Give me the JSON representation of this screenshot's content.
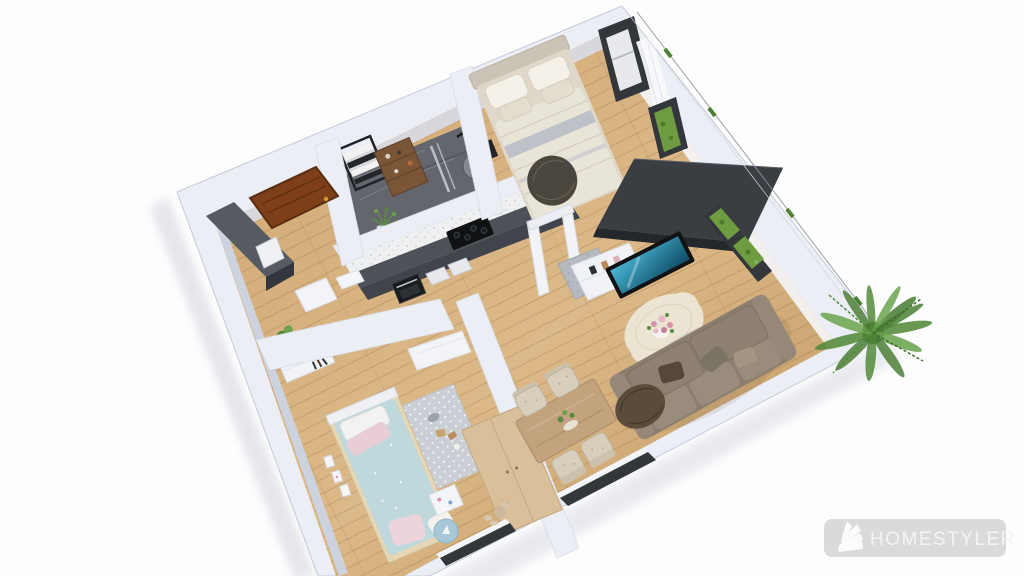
{
  "app": {
    "watermark_label": "HOMESTYLER"
  },
  "scene": {
    "view": "3d-top-down-floorplan-render",
    "rooms": [
      {
        "name": "entrance-hall",
        "items": [
          "entry-door",
          "shoe-wardrobe",
          "storage-shelf"
        ]
      },
      {
        "name": "bathroom",
        "items": [
          "towel-ladder",
          "wood-shelf",
          "shower-column",
          "glass-partition",
          "plant"
        ]
      },
      {
        "name": "bedroom",
        "items": [
          "double-bed",
          "round-dark-throw",
          "wardrobe",
          "corner-windows",
          "curtain"
        ]
      },
      {
        "name": "kitchen",
        "items": [
          "counter",
          "oven",
          "cooktop",
          "marble-backsplash"
        ]
      },
      {
        "name": "living-dining",
        "items": [
          "sofa",
          "cream-rug",
          "flower-centerpiece",
          "tv",
          "media-console",
          "dining-table",
          "four-chairs",
          "garden-window",
          "teddy-bear"
        ]
      },
      {
        "name": "kids-bedroom",
        "items": [
          "single-bed",
          "dotted-rug",
          "round-rug",
          "toy-shelf",
          "wardrobe",
          "wall-cards",
          "open-door"
        ]
      }
    ],
    "outside": [
      "boundary-line",
      "green-ticks",
      "bamboo-plant"
    ]
  },
  "colors": {
    "background": "#fdfdfe",
    "wall_top": "#eceef5",
    "wall_face": "#d8dce7",
    "wall_face_left": "#cdd2df",
    "wall_edge": "#c6cad6",
    "floor_light": "#dcb988",
    "floor_mid": "#cfa872",
    "floor_dark": "#c0975f",
    "marble_floor": "#63666c",
    "marble_vein": "#85888e",
    "entry_door": "#7c3f18",
    "door_frame": "#5a2c10",
    "hall_wardrobe": "#565b63",
    "dark_cabinet": "#41454b",
    "counter_dark": "#4e5258",
    "backsplash": "#eef0f2",
    "wardrobe_dark": "#3a3d42",
    "tv_screen_a": "#49b6d2",
    "tv_screen_b": "#0e4a66",
    "bed_frame": "#dfd8ca",
    "bed_duvet": "#e9e4d8",
    "bed_pillow": "#f4f1e9",
    "bed_stripe": "#b6bcc5",
    "bed_throw": "#4b463d",
    "kids_duvet": "#bfd8db",
    "kids_pillow_pink": "#e8cdd4",
    "kids_rug": "#c9cfd4",
    "kids_wardrobe": "#d9c09a",
    "sofa_base": "#8c7e6f",
    "sofa_cushion": "#9a8c7c",
    "sofa_throw": "#5b4b3b",
    "rug_cream": "#ece4d3",
    "flower_pink": "#d993a8",
    "table_wood": "#c2a37e",
    "chair_cream": "#d7cebc",
    "plant_green": "#4c7f37",
    "plant_green_mid": "#548a3b",
    "plant_green_light": "#6aa34e",
    "plant_green_dark": "#2e5520",
    "window_frame": "#33363b",
    "window_green": "#6f9c40",
    "boundary_line": "#90939c",
    "tick_green": "#4c8030",
    "watermark_bg": "#d8d8d8",
    "watermark_fg": "#f4f4f4"
  }
}
